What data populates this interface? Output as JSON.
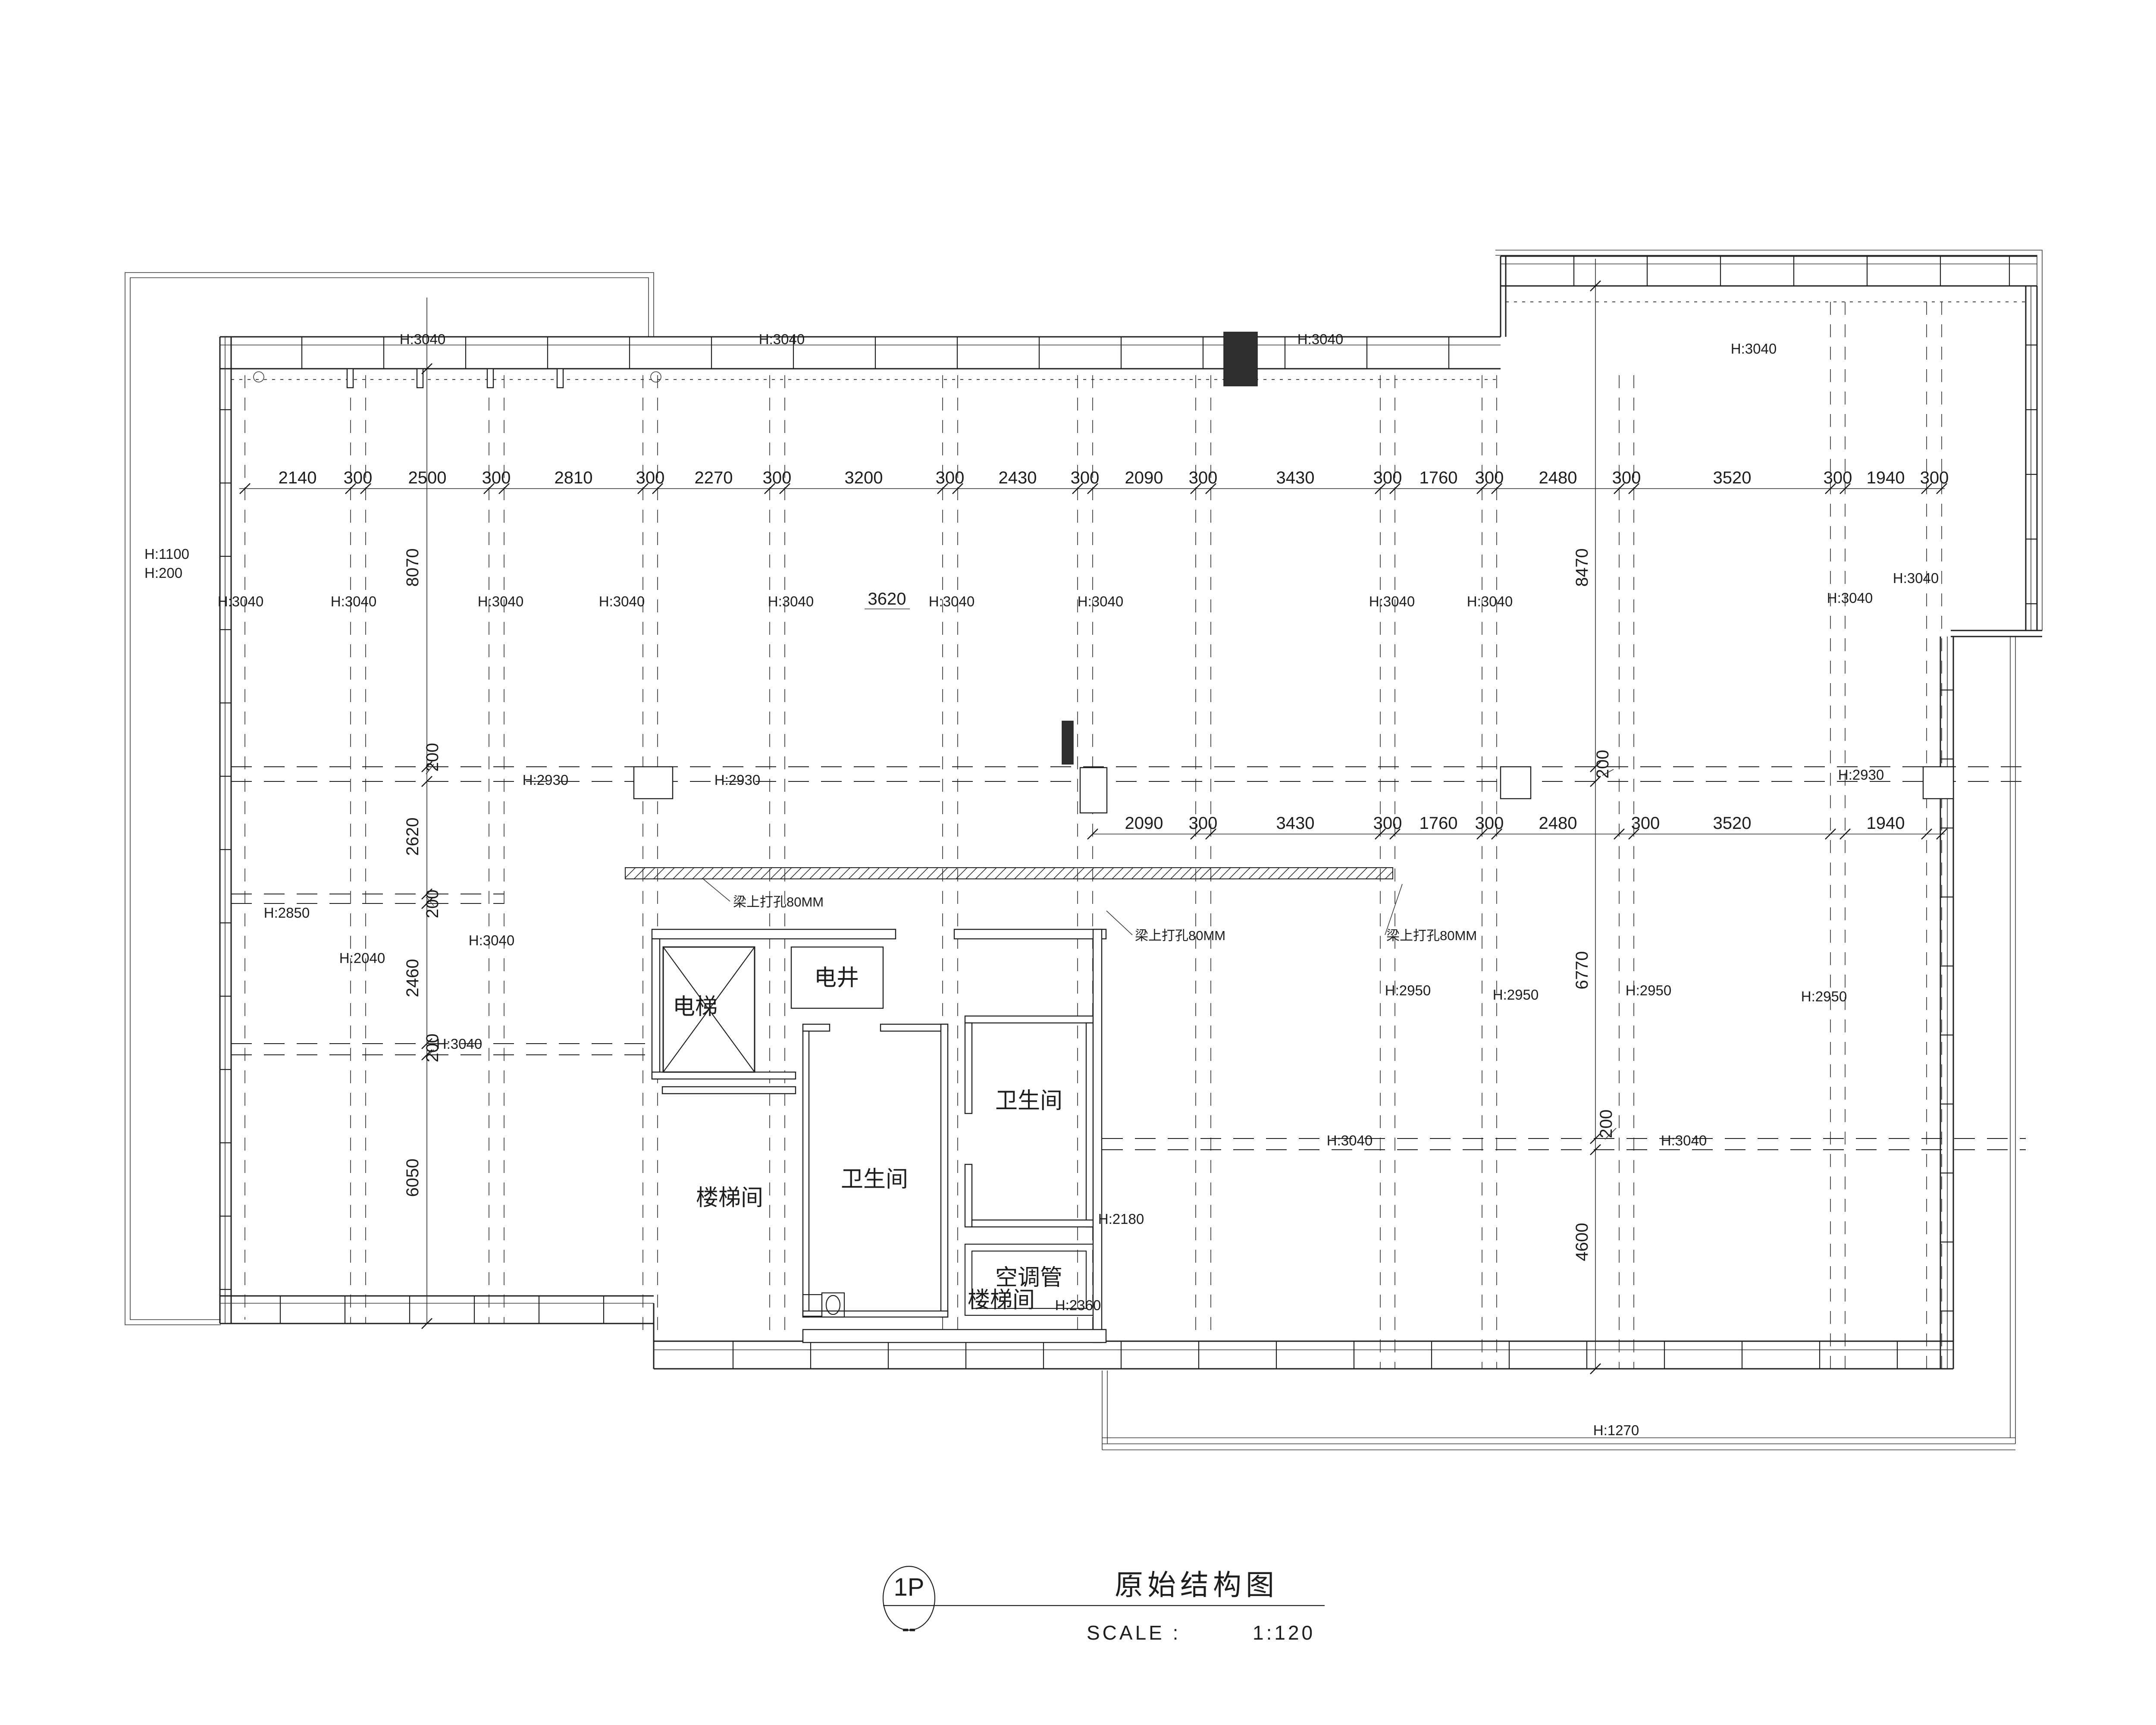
{
  "drawing": {
    "sheet_tag": "1P",
    "sheet_sub": "--",
    "title": "原始结构图",
    "scale_label": "SCALE :",
    "scale_value": "1:120"
  },
  "rooms": {
    "elevator": "电梯",
    "electric_shaft": "电井",
    "bathroom_right": "卫生间",
    "bathroom_left": "卫生间",
    "ac_duct": "空调管",
    "stairwell_upper": "楼梯间",
    "stairwell_lower": "楼梯间"
  },
  "annotations": {
    "beam_hole_note": "梁上打孔80MM"
  },
  "dims": {
    "top": [
      "2140",
      "300",
      "2500",
      "300",
      "2810",
      "300",
      "2270",
      "300",
      "3200",
      "300",
      "2430",
      "300",
      "2090",
      "300",
      "3430",
      "300",
      "1760",
      "300",
      "2480",
      "300",
      "3520",
      "300",
      "1940",
      "300"
    ],
    "mid": [
      "2090",
      "300",
      "3430",
      "300",
      "1760",
      "300",
      "2480",
      "300",
      "3520",
      "1940"
    ],
    "left": [
      "8070",
      "200",
      "2620",
      "200",
      "2460",
      "200",
      "6050"
    ],
    "right": [
      "8470",
      "200",
      "6770",
      "200",
      "4600"
    ],
    "floating": [
      "3620"
    ]
  },
  "heights": {
    "h3040": "H:3040",
    "h2930": "H:2930",
    "h2950": "H:2950",
    "h2850": "H:2850",
    "h2040": "H:2040",
    "h2180": "H:2180",
    "h2360": "H:2360",
    "h1270": "H:1270",
    "h1100": "H:1100",
    "h200": "H:200"
  },
  "colors": {
    "line": "#1f1f1f",
    "background": "#ffffff"
  }
}
